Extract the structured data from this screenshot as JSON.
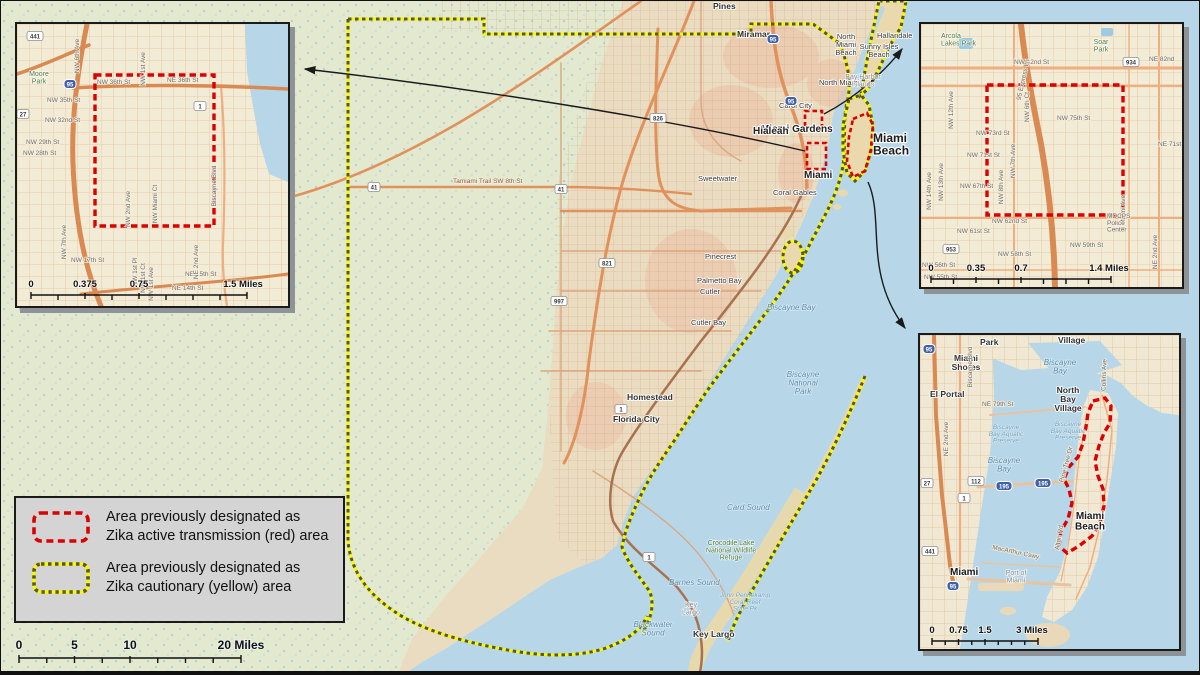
{
  "colors": {
    "ocean": "#b7d7e8",
    "land": "#e9dcc1",
    "everglades": "#e3e9ce",
    "inset_land": "#f2ebd6",
    "red_zone": "#dc0000",
    "yellow_zone": "#f8f800",
    "legend_bg": "#d4d4d4",
    "road_orange": "#e0915c"
  },
  "legend": {
    "red": {
      "line1": "Area previously designated as",
      "line2": "Zika active transmission (red) area"
    },
    "yellow": {
      "line1": "Area previously designated as",
      "line2": "Zika cautionary (yellow) area"
    }
  },
  "main_scale": {
    "t0": "0",
    "t1": "5",
    "t2": "10",
    "t3": "20 Miles"
  },
  "main_map": {
    "labels": [
      {
        "t": "Pines",
        "x": 712,
        "y": 8,
        "c": "town"
      },
      {
        "t": "Miramar",
        "x": 736,
        "y": 36,
        "c": "town"
      },
      {
        "t": "Hallandale",
        "x": 876,
        "y": 37,
        "c": "towns"
      },
      {
        "t": "Carol City",
        "x": 778,
        "y": 107,
        "c": "towns"
      },
      {
        "t": "Miami Gardens",
        "x": 760,
        "y": 131,
        "c": "city2"
      },
      {
        "t": "North\nMiami\nBeach",
        "x": 845,
        "y": 38,
        "c": "towns",
        "a": "middle"
      },
      {
        "t": "Sunny Isles\nBeach",
        "x": 878,
        "y": 48,
        "c": "towns",
        "a": "middle"
      },
      {
        "t": "North Miami",
        "x": 818,
        "y": 84,
        "c": "towns"
      },
      {
        "t": "Bay Harbor\nIslands",
        "x": 862,
        "y": 78,
        "c": "townlight",
        "a": "middle"
      },
      {
        "t": "Hialeah",
        "x": 752,
        "y": 133,
        "c": "city2"
      },
      {
        "t": "Miami\nBeach",
        "x": 872,
        "y": 141,
        "c": "city"
      },
      {
        "t": "Miami",
        "x": 803,
        "y": 177,
        "c": "city2"
      },
      {
        "t": "Sweetwater",
        "x": 697,
        "y": 180,
        "c": "towns"
      },
      {
        "t": "Coral Gables",
        "x": 772,
        "y": 194,
        "c": "towns"
      },
      {
        "t": "Pinecrest",
        "x": 704,
        "y": 258,
        "c": "towns"
      },
      {
        "t": "Palmetto Bay",
        "x": 696,
        "y": 282,
        "c": "towns"
      },
      {
        "t": "Cutler",
        "x": 699,
        "y": 293,
        "c": "towns"
      },
      {
        "t": "Cutler Bay",
        "x": 690,
        "y": 324,
        "c": "towns"
      },
      {
        "t": "Homestead",
        "x": 626,
        "y": 399,
        "c": "town"
      },
      {
        "t": "Florida City",
        "x": 612,
        "y": 421,
        "c": "town"
      },
      {
        "t": "Key Largo",
        "x": 692,
        "y": 636,
        "c": "town"
      },
      {
        "t": "Key\nLargo",
        "x": 690,
        "y": 606,
        "c": "townlight",
        "a": "middle"
      },
      {
        "t": "Biscayne Bay",
        "x": 766,
        "y": 309,
        "c": "water"
      },
      {
        "t": "Biscayne\nNational\nPark",
        "x": 802,
        "y": 376,
        "c": "water",
        "a": "middle"
      },
      {
        "t": "Card Sound",
        "x": 726,
        "y": 509,
        "c": "water"
      },
      {
        "t": "Barnes Sound",
        "x": 668,
        "y": 584,
        "c": "water"
      },
      {
        "t": "Blackwater\nSound",
        "x": 652,
        "y": 626,
        "c": "water",
        "a": "middle"
      },
      {
        "t": "John Pennekamp\nCoral Reef\nState Pk",
        "x": 744,
        "y": 596,
        "c": "waters",
        "a": "middle"
      },
      {
        "t": "Crocodile Lake\nNational Wildlife\nRefuge",
        "x": 730,
        "y": 544,
        "c": "park",
        "a": "middle"
      },
      {
        "t": "Tamiami Trail  SW 8th St",
        "x": 452,
        "y": 182,
        "c": "road"
      }
    ],
    "shields": [
      {
        "t": "95",
        "x": 772,
        "y": 38,
        "k": "i"
      },
      {
        "t": "95",
        "x": 790,
        "y": 100,
        "k": "i"
      },
      {
        "t": "826",
        "x": 657,
        "y": 117,
        "k": "s"
      },
      {
        "t": "821",
        "x": 606,
        "y": 262,
        "k": "s"
      },
      {
        "t": "41",
        "x": 373,
        "y": 186,
        "k": "s"
      },
      {
        "t": "41",
        "x": 560,
        "y": 188,
        "k": "s"
      },
      {
        "t": "997",
        "x": 558,
        "y": 300,
        "k": "s"
      },
      {
        "t": "1",
        "x": 620,
        "y": 408,
        "k": "s"
      },
      {
        "t": "1",
        "x": 648,
        "y": 556,
        "k": "s"
      }
    ]
  },
  "inset_wynwood": {
    "labels": [
      {
        "t": "NW 36th St",
        "x": 80,
        "y": 60,
        "c": "street"
      },
      {
        "t": "NE 36th St",
        "x": 150,
        "y": 58,
        "c": "street"
      },
      {
        "t": "NW 35th St",
        "x": 30,
        "y": 78,
        "c": "street"
      },
      {
        "t": "NW 32nd St",
        "x": 28,
        "y": 98,
        "c": "street"
      },
      {
        "t": "NW 29th St",
        "x": 9,
        "y": 120,
        "c": "street"
      },
      {
        "t": "NW 28th St",
        "x": 6,
        "y": 131,
        "c": "street"
      },
      {
        "t": "NW 17th St",
        "x": 54,
        "y": 238,
        "c": "street"
      },
      {
        "t": "NE 15th St",
        "x": 168,
        "y": 252,
        "c": "street"
      },
      {
        "t": "NE 14th St",
        "x": 155,
        "y": 266,
        "c": "street"
      },
      {
        "t": "NW 6th Ave",
        "x": 62,
        "y": 32,
        "c": "street",
        "r": -90,
        "a": "middle"
      },
      {
        "t": "NW 1st Ave",
        "x": 128,
        "y": 45,
        "c": "street",
        "r": -90,
        "a": "middle"
      },
      {
        "t": "NW 7th Ave",
        "x": 49,
        "y": 218,
        "c": "street",
        "r": -90,
        "a": "middle"
      },
      {
        "t": "NW 2nd Ave",
        "x": 113,
        "y": 185,
        "c": "street",
        "r": -90,
        "a": "middle"
      },
      {
        "t": "NW Miami Ct",
        "x": 140,
        "y": 180,
        "c": "street",
        "r": -90,
        "a": "middle"
      },
      {
        "t": "NW 1st Pl",
        "x": 120,
        "y": 248,
        "c": "street",
        "r": -90,
        "a": "middle"
      },
      {
        "t": "NW 1st Ct",
        "x": 128,
        "y": 254,
        "c": "street",
        "r": -90,
        "a": "middle"
      },
      {
        "t": "NW 1st Ave",
        "x": 136,
        "y": 260,
        "c": "street",
        "r": -90,
        "a": "middle"
      },
      {
        "t": "NE 2nd Ave",
        "x": 181,
        "y": 238,
        "c": "street",
        "r": -90,
        "a": "middle"
      },
      {
        "t": "Biscayne Blvd",
        "x": 199,
        "y": 162,
        "c": "street",
        "r": -90,
        "a": "middle"
      },
      {
        "t": "Moore\nPark",
        "x": 22,
        "y": 52,
        "c": "park",
        "a": "middle"
      }
    ],
    "shields": [
      {
        "t": "441",
        "x": 18,
        "y": 12,
        "k": "s"
      },
      {
        "t": "27",
        "x": 6,
        "y": 90,
        "k": "s"
      },
      {
        "t": "95",
        "x": 53,
        "y": 60,
        "k": "i"
      },
      {
        "t": "1",
        "x": 183,
        "y": 82,
        "k": "s"
      }
    ],
    "scale": {
      "t0": "0",
      "t1": "0.375",
      "t2": "0.75",
      "t3": "1.5 Miles"
    }
  },
  "inset_little_river": {
    "labels": [
      {
        "t": "NW 82nd St",
        "x": 93,
        "y": 40,
        "c": "street"
      },
      {
        "t": "NE 82nd",
        "x": 228,
        "y": 37,
        "c": "street"
      },
      {
        "t": "NW 75th St",
        "x": 136,
        "y": 96,
        "c": "street"
      },
      {
        "t": "NW 73rd St",
        "x": 55,
        "y": 111,
        "c": "street"
      },
      {
        "t": "NW 71st St",
        "x": 46,
        "y": 133,
        "c": "street"
      },
      {
        "t": "NW 67th St",
        "x": 39,
        "y": 164,
        "c": "street"
      },
      {
        "t": "NW 62nd St",
        "x": 71,
        "y": 199,
        "c": "street"
      },
      {
        "t": "NW 61st St",
        "x": 36,
        "y": 209,
        "c": "street"
      },
      {
        "t": "NW 59th St",
        "x": 149,
        "y": 223,
        "c": "street"
      },
      {
        "t": "NW 58th St",
        "x": 77,
        "y": 232,
        "c": "street"
      },
      {
        "t": "NE 71st",
        "x": 237,
        "y": 122,
        "c": "street"
      },
      {
        "t": "NW 56th St",
        "x": 1,
        "y": 243,
        "c": "street"
      },
      {
        "t": "NW 55th St",
        "x": 3,
        "y": 255,
        "c": "street"
      },
      {
        "t": "NW 12th Ave",
        "x": 32,
        "y": 86,
        "c": "street",
        "r": -90,
        "a": "middle"
      },
      {
        "t": "NW 13th Ave",
        "x": 22,
        "y": 158,
        "c": "street",
        "r": -90,
        "a": "middle"
      },
      {
        "t": "NW 14th Ave",
        "x": 10,
        "y": 167,
        "c": "street",
        "r": -90,
        "a": "middle"
      },
      {
        "t": "NW 8th Ave",
        "x": 82,
        "y": 163,
        "c": "street",
        "r": -90,
        "a": "middle"
      },
      {
        "t": "NW 7th Ave",
        "x": 94,
        "y": 137,
        "c": "street",
        "r": -90,
        "a": "middle"
      },
      {
        "t": "NW 6th Ct",
        "x": 108,
        "y": 83,
        "c": "street",
        "r": -90,
        "a": "middle"
      },
      {
        "t": "N Miami Ave",
        "x": 204,
        "y": 189,
        "c": "street",
        "r": -90,
        "a": "middle"
      },
      {
        "t": "NE 2nd Ave",
        "x": 236,
        "y": 228,
        "c": "street",
        "r": -90,
        "a": "middle"
      },
      {
        "t": "95 Express Ln",
        "x": 104,
        "y": 56,
        "c": "street",
        "r": -78,
        "a": "middle"
      },
      {
        "t": "Arcola\nLakes Park",
        "x": 20,
        "y": 14,
        "c": "park"
      },
      {
        "t": "Soar\nPark",
        "x": 180,
        "y": 20,
        "c": "park",
        "a": "middle"
      },
      {
        "t": "MDCPS\nPolice\nCenter",
        "x": 186,
        "y": 194,
        "c": "street"
      }
    ],
    "shields": [
      {
        "t": "934",
        "x": 210,
        "y": 38,
        "k": "s"
      },
      {
        "t": "953",
        "x": 30,
        "y": 225,
        "k": "s"
      }
    ],
    "scale": {
      "t0": "0",
      "t1": "0.35",
      "t2": "0.7",
      "t3": "1.4 Miles"
    }
  },
  "inset_miami_beach": {
    "labels": [
      {
        "t": "Park",
        "x": 60,
        "y": 10,
        "c": "town"
      },
      {
        "t": "Village",
        "x": 138,
        "y": 8,
        "c": "town"
      },
      {
        "t": "Miami\nShores",
        "x": 46,
        "y": 26,
        "c": "town",
        "a": "middle"
      },
      {
        "t": "El Portal",
        "x": 10,
        "y": 62,
        "c": "town"
      },
      {
        "t": "North\nBay\nVillage",
        "x": 148,
        "y": 58,
        "c": "town",
        "a": "middle"
      },
      {
        "t": "Biscayne\nBay",
        "x": 140,
        "y": 30,
        "c": "water",
        "a": "middle"
      },
      {
        "t": "Biscayne\nBay Aquatic\nPreserve",
        "x": 86,
        "y": 94,
        "c": "waters",
        "a": "middle"
      },
      {
        "t": "Biscayne\nBay Aquatic\nPreserve",
        "x": 148,
        "y": 91,
        "c": "waters",
        "a": "middle"
      },
      {
        "t": "Biscayne\nBay",
        "x": 84,
        "y": 128,
        "c": "water",
        "a": "middle"
      },
      {
        "t": "Miami",
        "x": 30,
        "y": 240,
        "c": "city3"
      },
      {
        "t": "Port of\nMiami",
        "x": 96,
        "y": 240,
        "c": "townlight",
        "a": "middle"
      },
      {
        "t": "Miami\nBeach",
        "x": 170,
        "y": 184,
        "c": "city3",
        "a": "middle"
      },
      {
        "t": "NE 79th St",
        "x": 62,
        "y": 71,
        "c": "street"
      },
      {
        "t": "MacArthur Cswy",
        "x": 72,
        "y": 214,
        "c": "street",
        "r": 12
      },
      {
        "t": "Alton Rd",
        "x": 141,
        "y": 203,
        "c": "street",
        "r": -80,
        "a": "middle"
      },
      {
        "t": "Pine Tree Dr",
        "x": 148,
        "y": 130,
        "c": "street",
        "r": -75,
        "a": "middle"
      },
      {
        "t": "Collins Ave",
        "x": 186,
        "y": 40,
        "c": "street",
        "r": -88,
        "a": "middle"
      },
      {
        "t": "Biscayne Blvd",
        "x": 52,
        "y": 32,
        "c": "street",
        "r": -90,
        "a": "middle"
      },
      {
        "t": "NE 2nd Ave",
        "x": 28,
        "y": 104,
        "c": "street",
        "r": -90,
        "a": "middle"
      }
    ],
    "shields": [
      {
        "t": "95",
        "x": 9,
        "y": 14,
        "k": "i"
      },
      {
        "t": "1",
        "x": 44,
        "y": 163,
        "k": "s"
      },
      {
        "t": "112",
        "x": 56,
        "y": 146,
        "k": "s"
      },
      {
        "t": "195",
        "x": 84,
        "y": 151,
        "k": "i"
      },
      {
        "t": "195",
        "x": 123,
        "y": 148,
        "k": "i"
      },
      {
        "t": "27",
        "x": 7,
        "y": 148,
        "k": "s"
      },
      {
        "t": "441",
        "x": 10,
        "y": 216,
        "k": "s"
      },
      {
        "t": "95",
        "x": 33,
        "y": 251,
        "k": "i"
      }
    ],
    "scale": {
      "t0": "0",
      "t1": "0.75",
      "t2": "1.5",
      "t3": "3 Miles"
    }
  }
}
